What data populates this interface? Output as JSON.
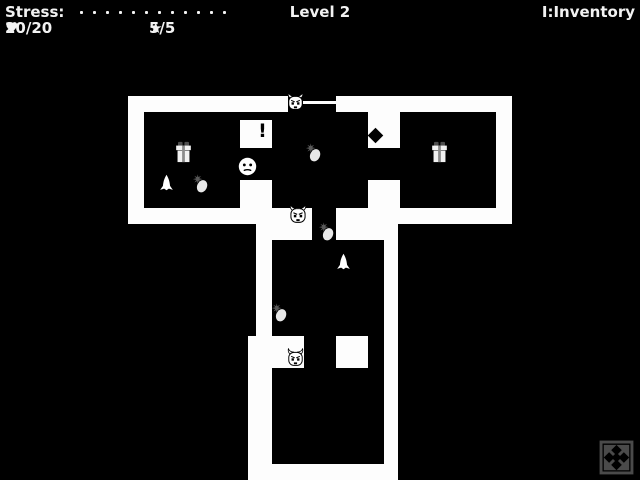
{
  "hud": {
    "stress_label": "Stress:",
    "stress_pips": 12,
    "hp_icon": "♥",
    "hp_value": "20/20",
    "star_icon": "★",
    "star_value": "5/5",
    "level_label": "Level 2",
    "inventory_hint": "I:Inventory"
  },
  "colors": {
    "background": "#000000",
    "wall": "#fdfdfd",
    "hud_text": "#f2f2f2",
    "gift_ribbon": "#8c8c8c",
    "gift_bow": "#4d4d4d",
    "pineapple_crown": "#595959",
    "fullscreen_icon": "#4a4a4a"
  },
  "map": {
    "walls": [
      [
        128,
        96,
        160,
        16
      ],
      [
        336,
        96,
        176,
        16
      ],
      [
        128,
        112,
        16,
        112
      ],
      [
        496,
        112,
        16,
        112
      ],
      [
        144,
        208,
        168,
        16
      ],
      [
        336,
        208,
        160,
        16
      ],
      [
        240,
        120,
        32,
        28
      ],
      [
        240,
        180,
        32,
        28
      ],
      [
        368,
        112,
        32,
        36
      ],
      [
        368,
        180,
        32,
        28
      ],
      [
        256,
        224,
        56,
        16
      ],
      [
        336,
        224,
        48,
        16
      ],
      [
        256,
        240,
        16,
        96
      ],
      [
        384,
        224,
        14,
        248
      ],
      [
        248,
        336,
        56,
        32
      ],
      [
        336,
        336,
        32,
        32
      ],
      [
        248,
        368,
        24,
        96
      ],
      [
        248,
        464,
        150,
        16
      ],
      [
        303,
        101,
        33,
        3
      ]
    ],
    "entities": [
      {
        "type": "imp",
        "name": "imp-enemy-top",
        "x": 286,
        "y": 92,
        "w": 19,
        "h": 19
      },
      {
        "type": "imp",
        "name": "imp-enemy-middle",
        "x": 288,
        "y": 204,
        "w": 20,
        "h": 20
      },
      {
        "type": "imp",
        "name": "imp-enemy-bottom",
        "x": 286,
        "y": 348,
        "w": 19,
        "h": 19
      },
      {
        "type": "player",
        "name": "player-character",
        "x": 238,
        "y": 157,
        "w": 19,
        "h": 19
      },
      {
        "type": "gift",
        "name": "gift-item-left-room",
        "x": 172,
        "y": 141,
        "w": 23,
        "h": 22
      },
      {
        "type": "gift",
        "name": "gift-item-right-room",
        "x": 428,
        "y": 141,
        "w": 23,
        "h": 22
      },
      {
        "type": "rocket",
        "name": "rocket-item-left-room",
        "x": 157,
        "y": 173,
        "w": 19,
        "h": 21
      },
      {
        "type": "rocket",
        "name": "rocket-item-middle-room",
        "x": 334,
        "y": 252,
        "w": 19,
        "h": 21
      },
      {
        "type": "pineapple",
        "name": "pineapple-item-left-room",
        "x": 191,
        "y": 173,
        "w": 19,
        "h": 21
      },
      {
        "type": "pineapple",
        "name": "pineapple-item-center-room",
        "x": 304,
        "y": 142,
        "w": 19,
        "h": 21
      },
      {
        "type": "pineapple",
        "name": "pineapple-item-corridor",
        "x": 317,
        "y": 221,
        "w": 19,
        "h": 21
      },
      {
        "type": "pineapple",
        "name": "pineapple-item-lower-room",
        "x": 270,
        "y": 302,
        "w": 19,
        "h": 21
      },
      {
        "type": "glyph",
        "glyph": "!",
        "name": "exclamation-marker",
        "x": 256,
        "y": 120,
        "w": 13,
        "h": 22
      },
      {
        "type": "diamond",
        "name": "diamond-door-marker",
        "x": 370,
        "y": 130,
        "w": 11,
        "h": 11
      }
    ]
  }
}
